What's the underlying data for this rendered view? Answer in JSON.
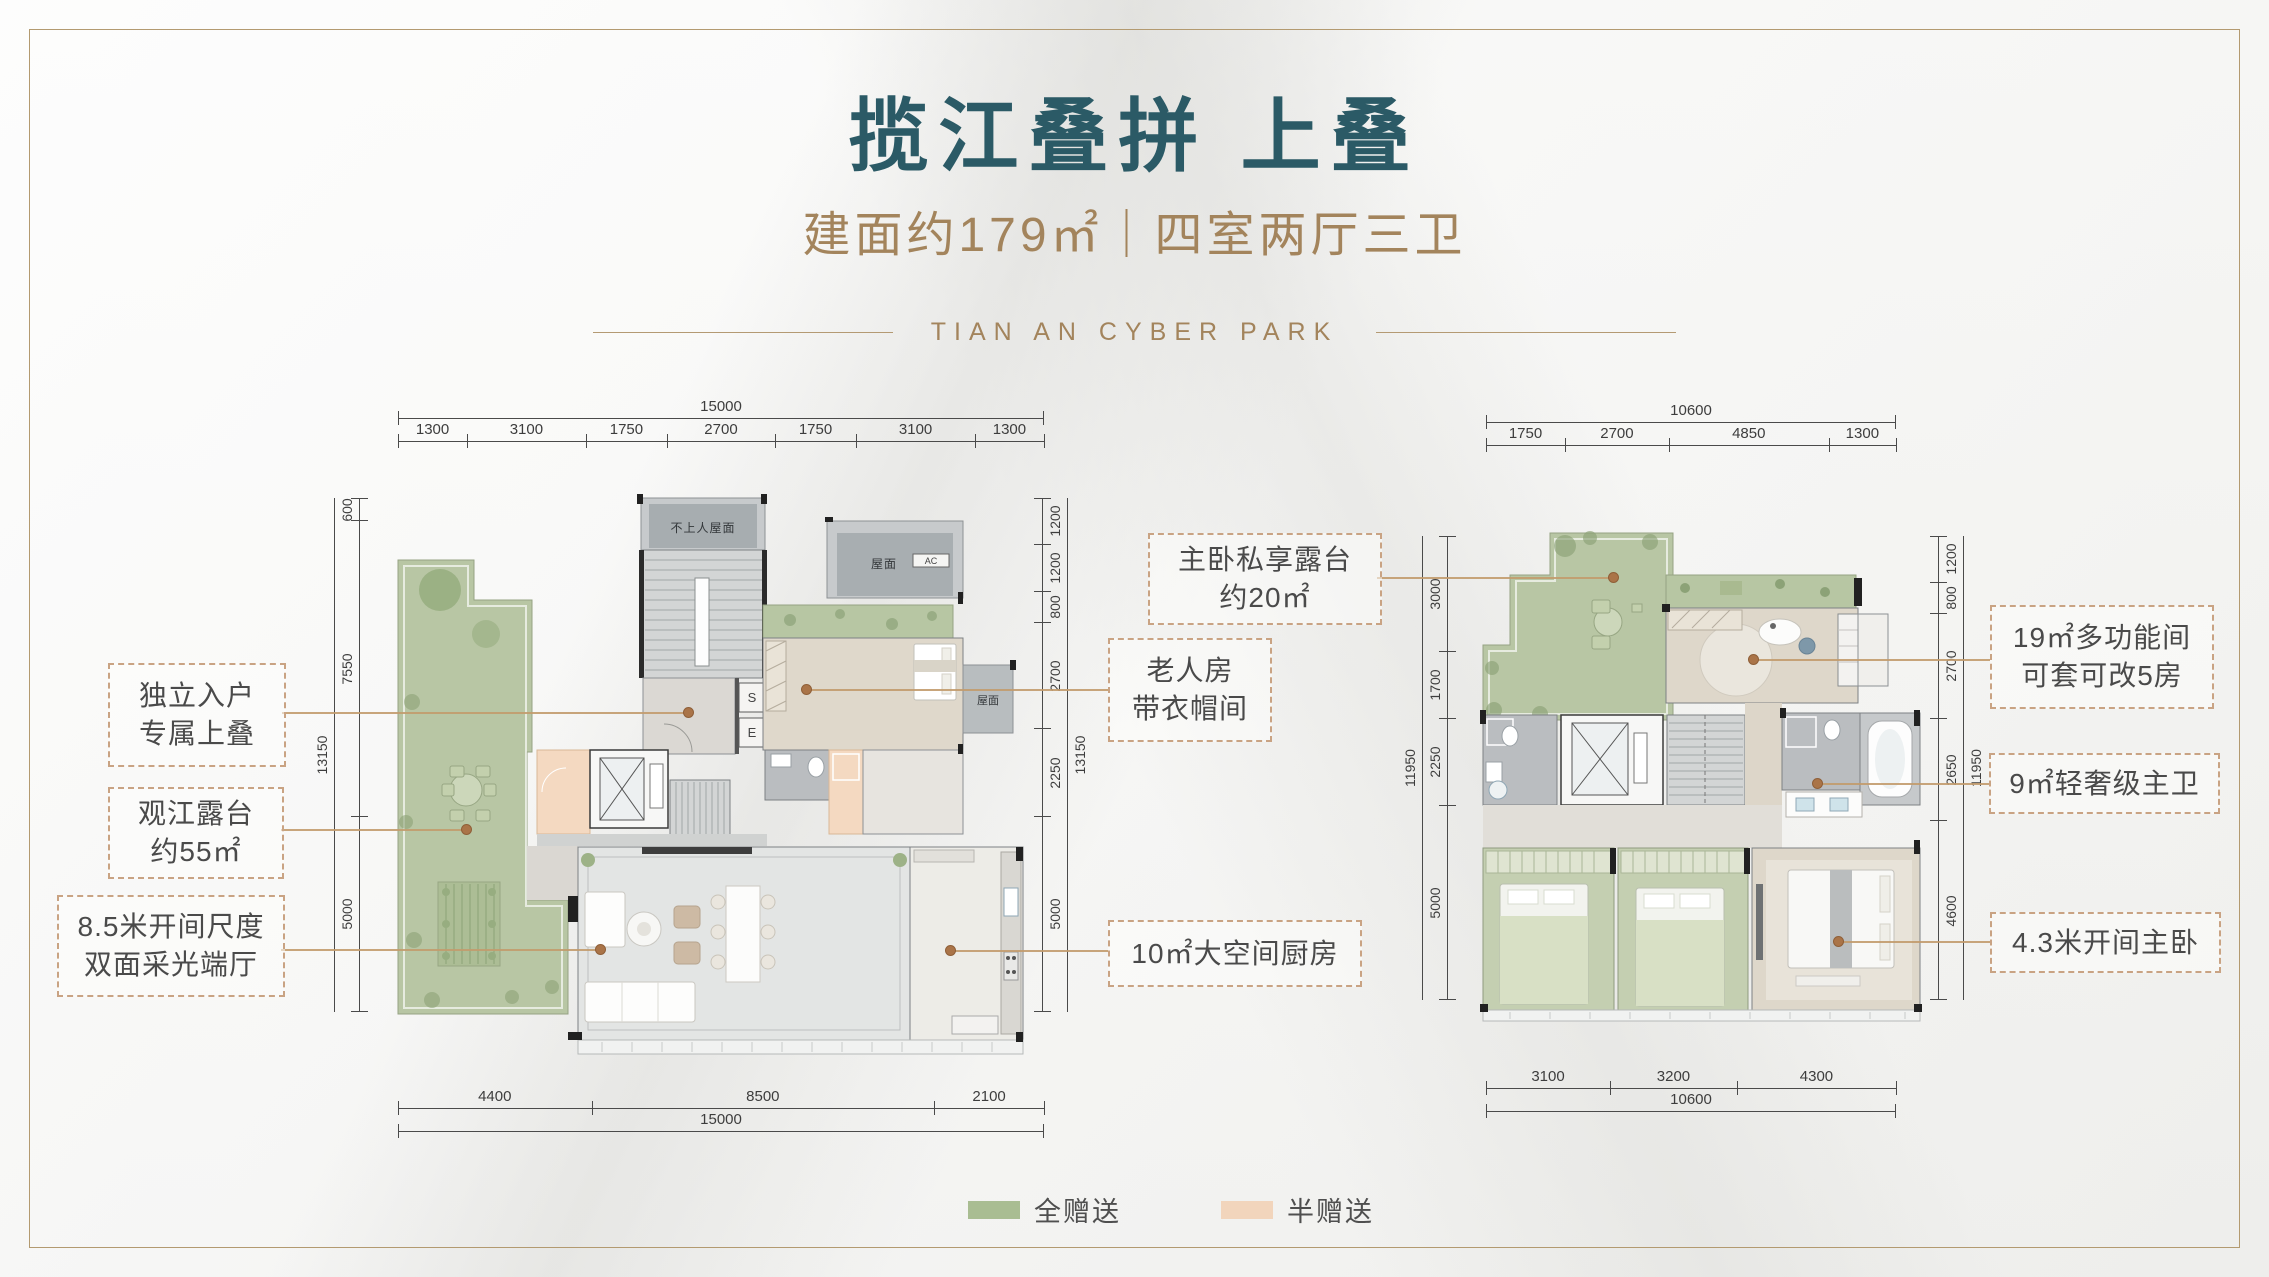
{
  "colors": {
    "title_teal": "#2b5a66",
    "gold": "#a3845c",
    "leader_tan": "#c29b6d",
    "full_gift_green": "#a9bd92",
    "half_gift_peach": "#f2d5bc"
  },
  "header": {
    "title": "揽江叠拼 上叠",
    "subtitle": "建面约179㎡｜四室两厅三卫",
    "brand": "TIAN AN CYBER PARK"
  },
  "legend": {
    "full": {
      "label": "全赠送"
    },
    "half": {
      "label": "半赠送"
    }
  },
  "callouts": {
    "entry": {
      "line1": "独立入户",
      "line2": "专属上叠"
    },
    "river_terrace": {
      "line1": "观江露台",
      "line2": "约55㎡"
    },
    "hall": {
      "line1": "8.5米开间尺度",
      "line2": "双面采光端厅"
    },
    "master_terrace": {
      "line1": "主卧私享露台",
      "line2": "约20㎡"
    },
    "elder_room": {
      "line1": "老人房",
      "line2": "带衣帽间"
    },
    "kitchen": {
      "line1": "10㎡大空间厨房"
    },
    "multi_room": {
      "line1": "19㎡多功能间",
      "line2": "可套可改5房"
    },
    "master_bath": {
      "line1": "9㎡轻奢级主卫"
    },
    "master_bed": {
      "line1": "4.3米开间主卧"
    }
  },
  "plan_labels": {
    "roof_no_access": "不上人屋面",
    "roof": "屋面",
    "cabinet_s": "S",
    "cabinet_e": "E",
    "ac": "AC"
  },
  "dims": {
    "left_plan": {
      "top": {
        "total": "15000",
        "segments": [
          "1300",
          "3100",
          "1750",
          "2700",
          "1750",
          "3100",
          "1300"
        ]
      },
      "bottom": {
        "total": "15000",
        "segments": [
          "4400",
          "8500",
          "2100"
        ]
      },
      "left": {
        "total": "13150",
        "segments": [
          "600",
          "7550",
          "5000"
        ]
      },
      "right": {
        "total": "13150",
        "segments": [
          "1200",
          "1200",
          "800",
          "2700",
          "2250",
          "5000"
        ]
      }
    },
    "right_plan": {
      "top": {
        "total": "10600",
        "segments": [
          "1750",
          "2700",
          "4850",
          "1300"
        ]
      },
      "bottom": {
        "total": "10600",
        "segments": [
          "3100",
          "3200",
          "4300"
        ]
      },
      "left": {
        "total": "11950",
        "segments": [
          "3000",
          "1700",
          "2250",
          "5000"
        ]
      },
      "right": {
        "total": "11950",
        "segments": [
          "1200",
          "800",
          "2700",
          "2650",
          "4600"
        ]
      }
    }
  }
}
